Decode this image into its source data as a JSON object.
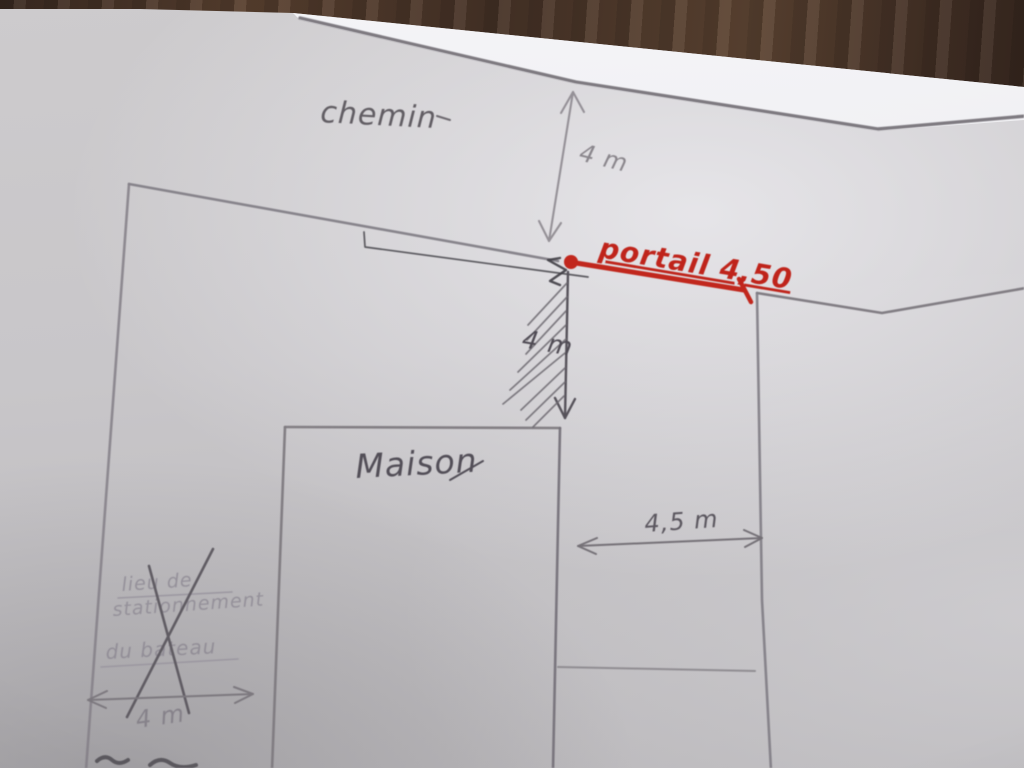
{
  "scene": {
    "description": "Photograph of a hand-drawn property site plan (pencil and red marker) on a sheet of paper lying on a wooden table",
    "colors": {
      "wood_table": "#4a3327",
      "paper": "#c8c6c8",
      "pencil": "#7f7b80",
      "pen": "#46444b",
      "red_marker": "#c1271d"
    }
  },
  "labels": {
    "chemin": "chemin",
    "dim_road_width": "4 m",
    "portail": "portail 4,50",
    "dim_driveway_depth": "4 m",
    "maison": "Maison",
    "dim_strip_width": "4,5 m",
    "crossed_out_line1": "lieu de",
    "crossed_out_line2": "stationnement",
    "crossed_out_line3": "du bateau",
    "dim_boat_area": "4 m"
  }
}
